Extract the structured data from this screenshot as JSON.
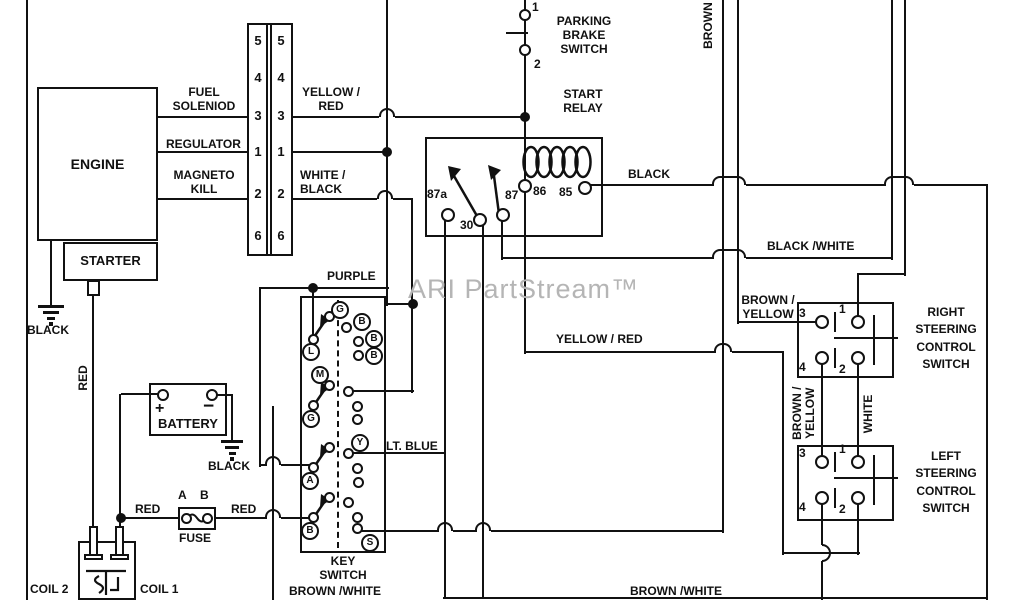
{
  "colors": {
    "line": "#111111",
    "background": "#ffffff",
    "watermark": "#b5b5b5"
  },
  "watermark": "ARI PartStream™",
  "engine": {
    "title": "ENGINE",
    "starter": "STARTER",
    "ground": "BLACK"
  },
  "connector": {
    "pins_left": [
      "5",
      "4",
      "3",
      "1",
      "2",
      "6"
    ],
    "pins_right": [
      "5",
      "4",
      "3",
      "1",
      "2",
      "6"
    ]
  },
  "engine_lines": {
    "fuel1": "FUEL",
    "fuel2": "SOLENIOD",
    "regulator": "REGULATOR",
    "magneto1": "MAGNETO",
    "magneto2": "KILL"
  },
  "wires": {
    "yellow_red_a1": "YELLOW /",
    "yellow_red_a2": "RED",
    "white_black1": "WHITE /",
    "white_black2": "BLACK",
    "purple": "PURPLE",
    "relay_black": "BLACK",
    "black_white": "BLACK /WHITE",
    "brown_vertical": "BROWN",
    "yellow_red_b": "YELLOW / RED",
    "lt_blue": "LT. BLUE",
    "red_left": "RED",
    "red_right": "RED",
    "red_vertical": "RED",
    "brown_yellow1": "BROWN /",
    "brown_yellow2": "YELLOW",
    "brown_yellow_v1": "BROWN /",
    "brown_yellow_v2": "YELLOW",
    "white_vertical": "WHITE",
    "brown_white_left": "BROWN /WHITE",
    "brown_white_right": "BROWN /WHITE"
  },
  "parking_brake": {
    "line1": "PARKING",
    "line2": "BRAKE",
    "line3": "SWITCH",
    "pin1": "1",
    "pin2": "2"
  },
  "start_relay": {
    "line1": "START",
    "line2": "RELAY",
    "t_87a": "87a",
    "t_30": "30",
    "t_87": "87",
    "t_86": "86",
    "t_85": "85"
  },
  "right_steering": {
    "line1": "RIGHT",
    "line2": "STEERING",
    "line3": "CONTROL",
    "line4": "SWITCH",
    "t3": "3",
    "t1": "1",
    "t4": "4",
    "t2": "2"
  },
  "left_steering": {
    "line1": "LEFT",
    "line2": "STEERING",
    "line3": "CONTROL",
    "line4": "SWITCH",
    "t3": "3",
    "t1": "1",
    "t4": "4",
    "t2": "2"
  },
  "key_switch": {
    "line1": "KEY",
    "line2": "SWITCH",
    "t_g1": "G",
    "t_b1": "B",
    "t_b2": "B",
    "t_b3": "B",
    "t_l": "L",
    "t_m": "M",
    "t_g2": "G",
    "t_y": "Y",
    "t_a": "A",
    "t_b4": "B",
    "t_s": "S"
  },
  "battery": {
    "title": "BATTERY",
    "plus": "+",
    "minus": "−",
    "ground": "BLACK"
  },
  "fuse": {
    "title": "FUSE",
    "a": "A",
    "b": "B"
  },
  "coil": {
    "coil1": "COIL 1",
    "coil2": "COIL 2"
  }
}
